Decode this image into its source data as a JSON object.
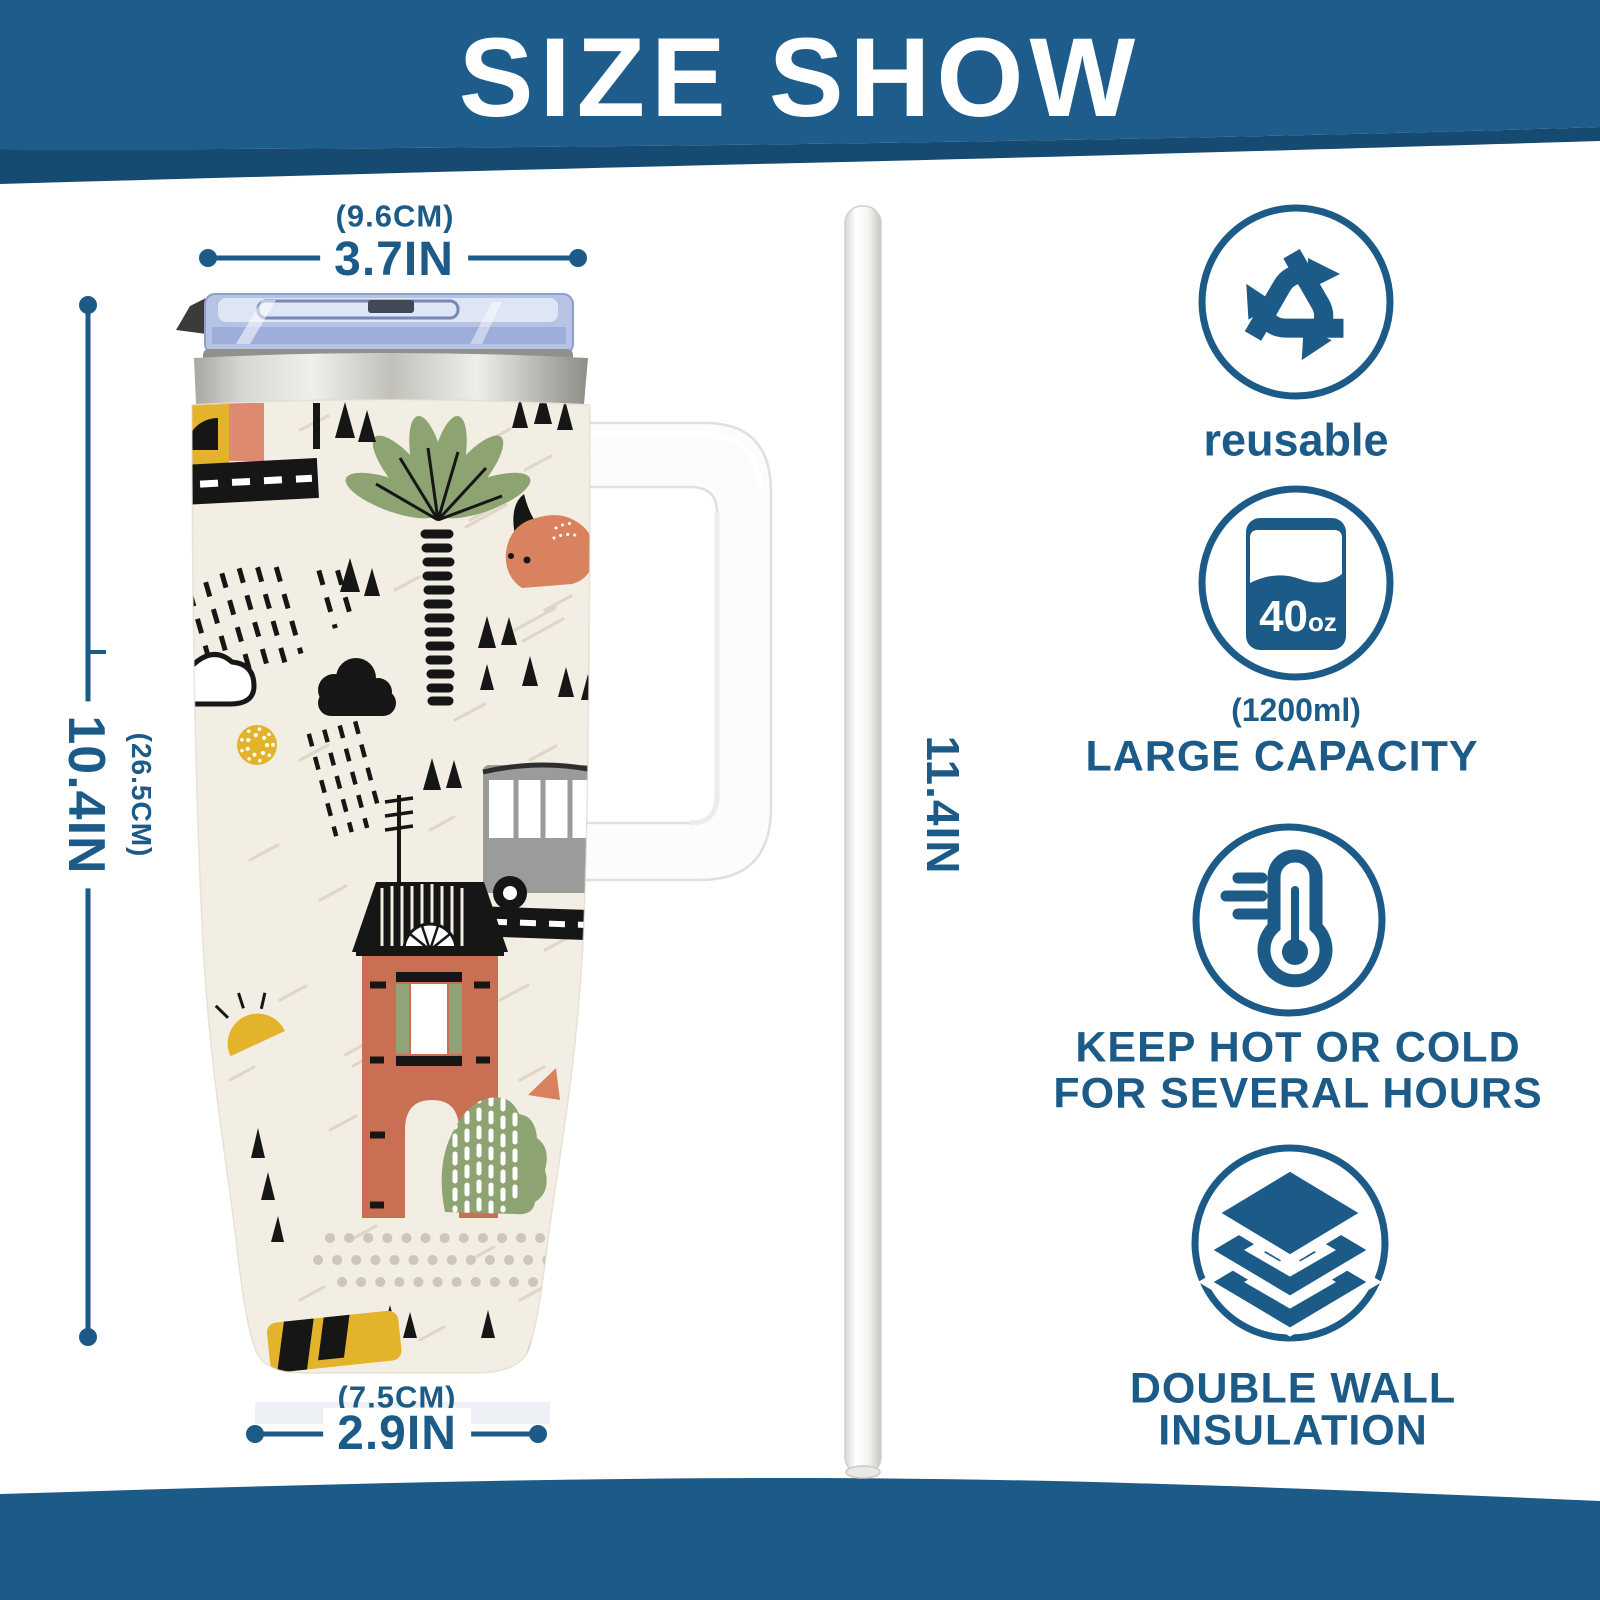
{
  "header": {
    "title": "SIZE SHOW"
  },
  "dimensions": {
    "top_width_cm": "(9.6CM)",
    "top_width_in": "3.7IN",
    "height_cm": "(26.5CM)",
    "height_in": "10.4IN",
    "straw_length_in": "11.4IN",
    "bottom_width_cm": "(7.5CM)",
    "bottom_width_in": "2.9IN"
  },
  "features": {
    "reusable": {
      "icon": "recycle-icon",
      "label": "reusable"
    },
    "capacity": {
      "icon": "capacity-icon",
      "value": "40",
      "unit": "oz",
      "metric": "(1200ml)",
      "label": "LARGE CAPACITY"
    },
    "insulated": {
      "icon": "thermometer-icon",
      "line1": "KEEP HOT OR COLD",
      "line2": "FOR SEVERAL HOURS"
    },
    "double_wall": {
      "icon": "layers-icon",
      "line1": "DOUBLE WALL",
      "line2": "INSULATION"
    }
  },
  "colors": {
    "primary_blue": "#1c5b88",
    "banner_blue": "#1e5d8b",
    "banner_dark": "#164a70",
    "cream": "#f2eee3",
    "terracotta": "#c96f54",
    "salmon": "#d9825f",
    "green": "#8da371",
    "yellow": "#e3b32b",
    "bus_gray": "#9b9b9b",
    "ink_black": "#161616"
  }
}
